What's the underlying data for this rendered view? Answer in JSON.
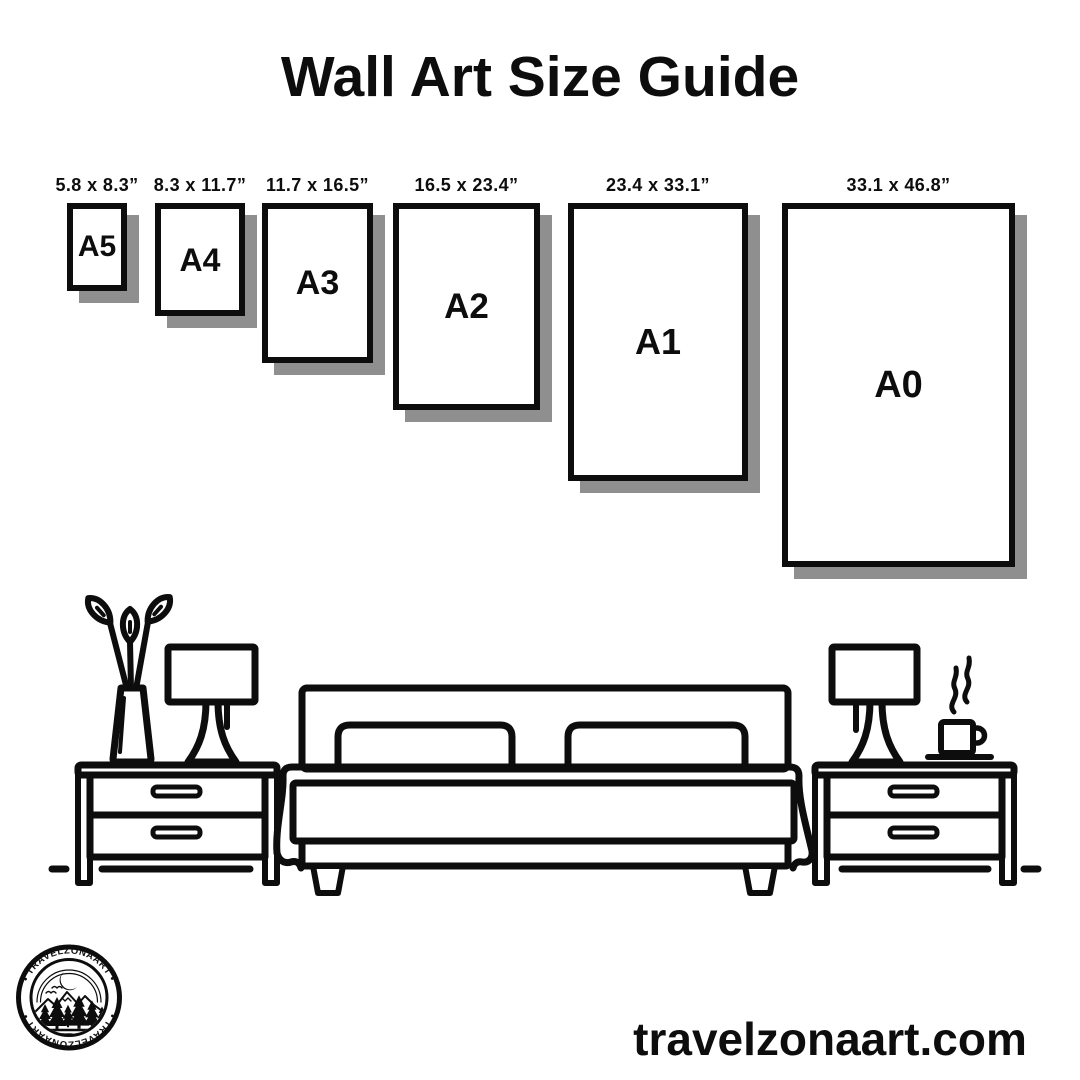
{
  "title": "Wall Art Size Guide",
  "website": "travelzonaart.com",
  "logo": {
    "brand_top": "• TRAVELZONAART •",
    "brand_bottom": "• TRAVELZONAART •"
  },
  "sizes": [
    {
      "label": "A5",
      "dimensions": "5.8 x 8.3”"
    },
    {
      "label": "A4",
      "dimensions": "8.3 x 11.7”"
    },
    {
      "label": "A3",
      "dimensions": "11.7 x 16.5”"
    },
    {
      "label": "A2",
      "dimensions": "16.5 x 23.4”"
    },
    {
      "label": "A1",
      "dimensions": "23.4 x 33.1”"
    },
    {
      "label": "A0",
      "dimensions": "33.1 x 46.8”"
    }
  ],
  "scene_icons": [
    "plant-vase-icon",
    "table-lamp-icon",
    "nightstand-icon",
    "double-bed-icon",
    "coffee-cup-icon"
  ],
  "colors": {
    "ink": "#0d0d0d",
    "frame_shadow": "#8f8f8f",
    "background": "#ffffff"
  }
}
